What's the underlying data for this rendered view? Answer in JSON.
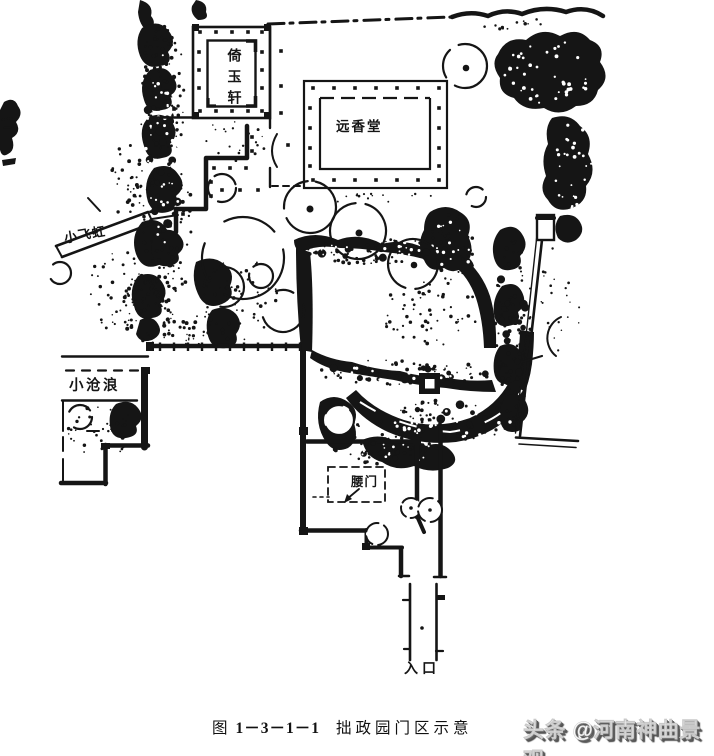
{
  "page": {
    "background": "#ffffff",
    "ink": "#151515"
  },
  "map": {
    "labels": {
      "yiyuxuan": "倚玉轩",
      "yuanxiangtang": "远香堂",
      "xiaofeihong": "小飞虹",
      "xiaocanglang": "小沧浪",
      "yaomen": "腰门",
      "rukou": "入口"
    }
  },
  "caption": {
    "prefix": "图",
    "number": "1－3－1－1",
    "title": "拙政园门区示意"
  },
  "watermark": {
    "text": "头条 @河南神曲景观"
  }
}
